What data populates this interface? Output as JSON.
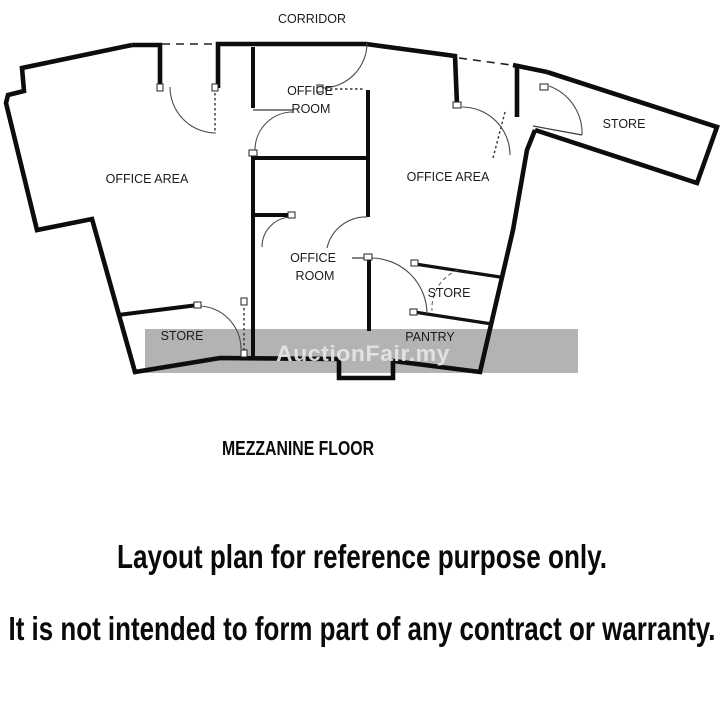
{
  "plan": {
    "corridor_label": "CORRIDOR",
    "floor_name": "MEZZANINE FLOOR",
    "rooms": {
      "office_room_top": {
        "line1": "OFFICE",
        "line2": "ROOM"
      },
      "office_area_left": "OFFICE AREA",
      "office_area_right": "OFFICE AREA",
      "store_top_right": "STORE",
      "office_room_mid": {
        "line1": "OFFICE",
        "line2": "ROOM"
      },
      "store_right": "STORE",
      "pantry": "PANTRY",
      "store_left": "STORE"
    }
  },
  "watermark": {
    "text": "AuctionFair.my",
    "band_color": "#b3b3b3",
    "text_color": "#e8e8e8"
  },
  "disclaimer": {
    "line1": "Layout plan for reference purpose only.",
    "line2": "It is not intended to form part of any contract or warranty."
  },
  "colors": {
    "background": "#ffffff",
    "wall": "#0d0d0d",
    "label_text": "#1c1c1c"
  }
}
